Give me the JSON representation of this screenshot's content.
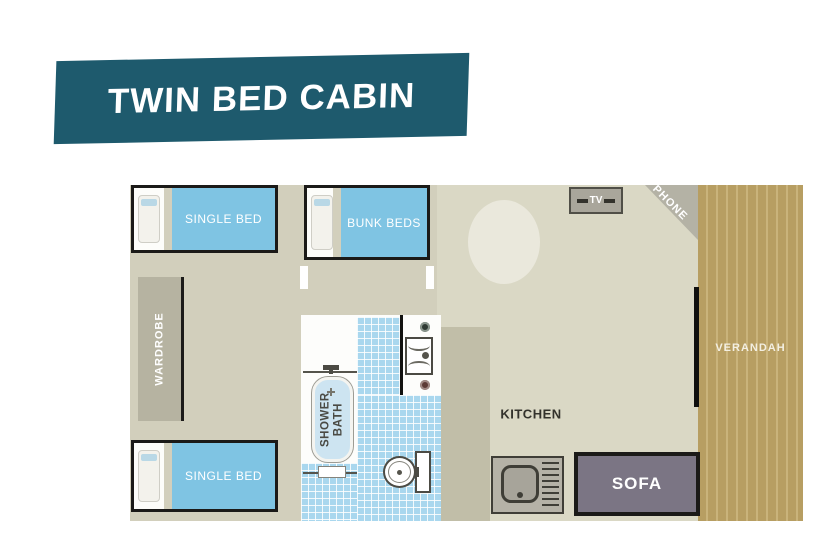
{
  "banner": {
    "title": "TWIN BED CABIN"
  },
  "floorplan": {
    "bedroom_top": {
      "bed_label": "SINGLE BED"
    },
    "bunk_room": {
      "bed_label": "BUNK BEDS"
    },
    "bedroom_bottom": {
      "bed_label": "SINGLE BED"
    },
    "wardrobe": {
      "label": "WARDROBE"
    },
    "bathroom": {
      "tub_label": "SHOWER BATH"
    },
    "kitchen": {
      "label": "KITCHEN"
    },
    "living": {
      "sofa_label": "SOFA",
      "tv_label": "TV",
      "phone_label": "PHONE"
    },
    "verandah": {
      "label": "VERANDAH"
    }
  },
  "colors": {
    "banner_teal": "#1e5a6d",
    "floor_khaki": "#d2cfbc",
    "living_floor": "#dad8c5",
    "bed_blue": "#7fc4e3",
    "tile_blue": "#a9d7ee",
    "verandah_tan": "#b79e62",
    "sofa_gray": "#7b7584",
    "wardrobe_gray": "#b6b3a1"
  }
}
